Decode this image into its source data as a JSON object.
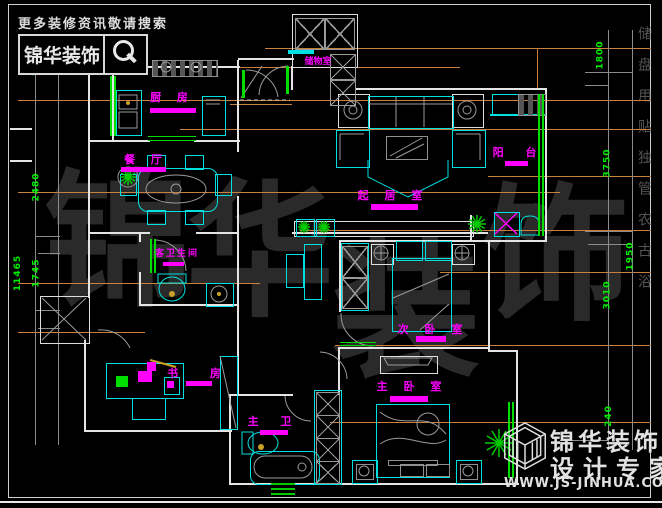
{
  "branding": {
    "search_hint": "更多装修资讯敬请搜索",
    "logo_name": "锦华装饰",
    "footer_line1": "锦华装饰",
    "footer_line2": "设计专家",
    "footer_url": "WWW.JS-JINHUA.COM"
  },
  "rooms": {
    "kitchen": "厨 房",
    "dining": "餐 厅",
    "living": "起 居 室",
    "balcony": "阳 台",
    "storage": "储物室",
    "guest_bath": "客卫生间",
    "second_bedroom": "次 卧 室",
    "study": "书 房",
    "master_bath": "主 卫",
    "master_bedroom": "主 卧 室"
  },
  "dimensions": {
    "left": [
      "850",
      "2480",
      "11465",
      "1745"
    ],
    "right": [
      "1800",
      "3750",
      "1950",
      "3010",
      "240"
    ]
  },
  "watermark": {
    "main": [
      "锦",
      "华",
      "装",
      "饰"
    ],
    "side": "储盘用贴独管农古浴"
  },
  "colors": {
    "furniture_cyan": "#00e0e0",
    "label_magenta": "#ff00ff",
    "door_window_green": "#00dd00",
    "leader_tan": "#c9803f",
    "wall_white": "#e4e4e4",
    "dimension_green": "#00ee00"
  }
}
